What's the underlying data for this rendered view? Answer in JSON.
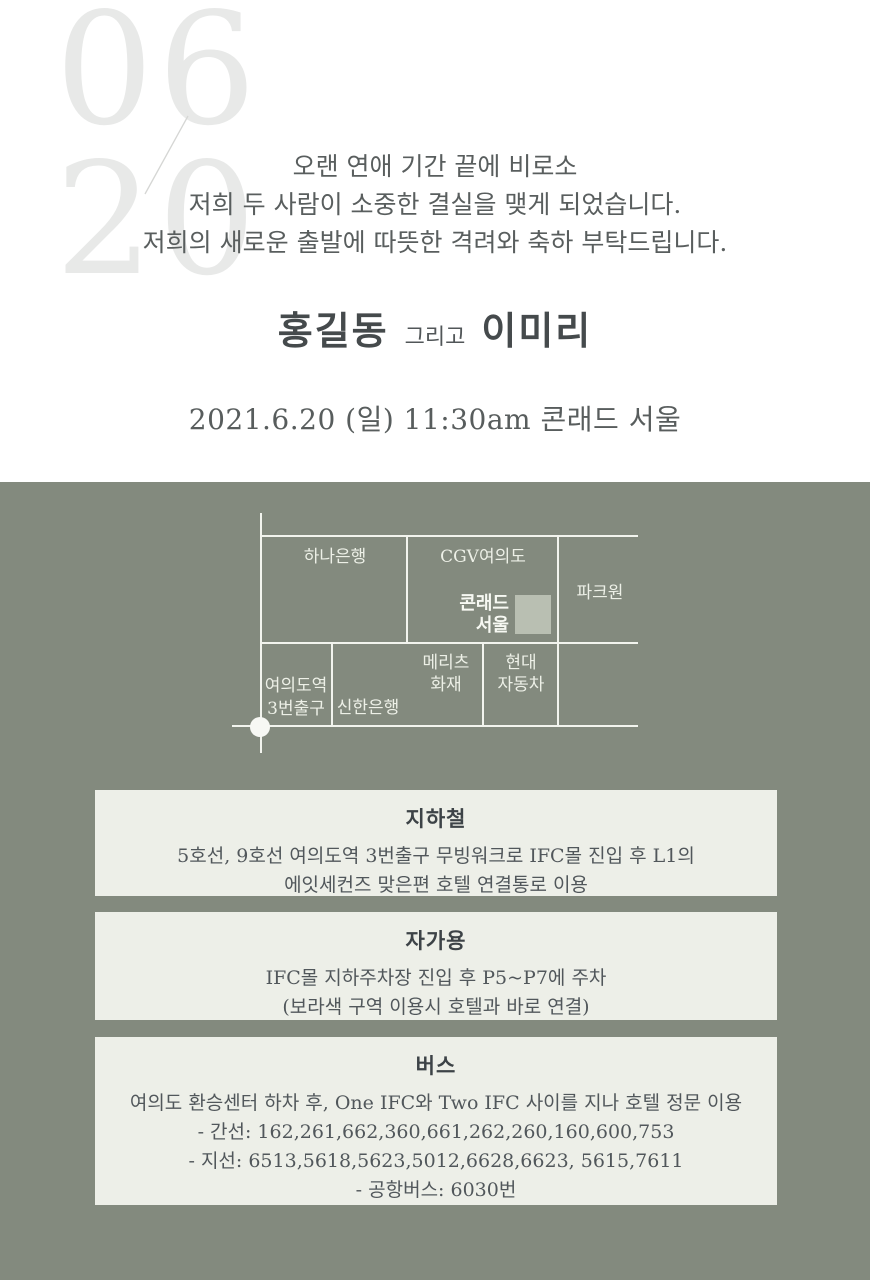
{
  "hero": {
    "big_month": "06",
    "big_day": "20",
    "greeting_lines": [
      "오랜 연애 기간 끝에 비로소",
      "저희 두 사람이 소중한 결실을 맺게 되었습니다.",
      "저희의 새로운 출발에 따뜻한 격려와 축하 부탁드립니다."
    ],
    "groom_name": "홍길동",
    "conjunction": "그리고",
    "bride_name": "이미리",
    "event_datetime": "2021.6.20 (일) 11:30am 콘래드 서울"
  },
  "map": {
    "labels": {
      "hana_bank": "하나은행",
      "cgv": "CGV여의도",
      "parc1": "파크원",
      "conrad_line1": "콘래드",
      "conrad_line2": "서울",
      "meritz_line1": "메리츠",
      "meritz_line2": "화재",
      "hyundai_line1": "현대",
      "hyundai_line2": "자동차",
      "shinhan_bank": "신한은행",
      "station_line1": "여의도역",
      "station_line2": "3번출구"
    }
  },
  "directions": [
    {
      "title": "지하철",
      "lines": [
        "5호선, 9호선 여의도역 3번출구 무빙워크로 IFC몰 진입 후 L1의",
        "에잇세컨즈 맞은편 호텔 연결통로 이용"
      ]
    },
    {
      "title": "자가용",
      "lines": [
        "IFC몰 지하주차장 진입 후 P5~P7에 주차",
        "(보라색 구역 이용시 호텔과 바로 연결)"
      ]
    },
    {
      "title": "버스",
      "lines": [
        "여의도 환승센터 하차 후, One IFC와 Two IFC 사이를 지나 호텔 정문 이용",
        "- 간선: 162,261,662,360,661,262,260,160,600,753",
        "- 지선: 6513,5618,5623,5012,6628,6623, 5615,7611",
        "- 공항버스: 6030번"
      ]
    }
  ],
  "colors": {
    "sage_background": "#838a7e",
    "card_background": "#edefe8",
    "map_line": "#f2f4ee",
    "conrad_block_fill": "#b9bfb2",
    "numeral_gray": "#e8e9e8",
    "body_text": "#51575b"
  }
}
